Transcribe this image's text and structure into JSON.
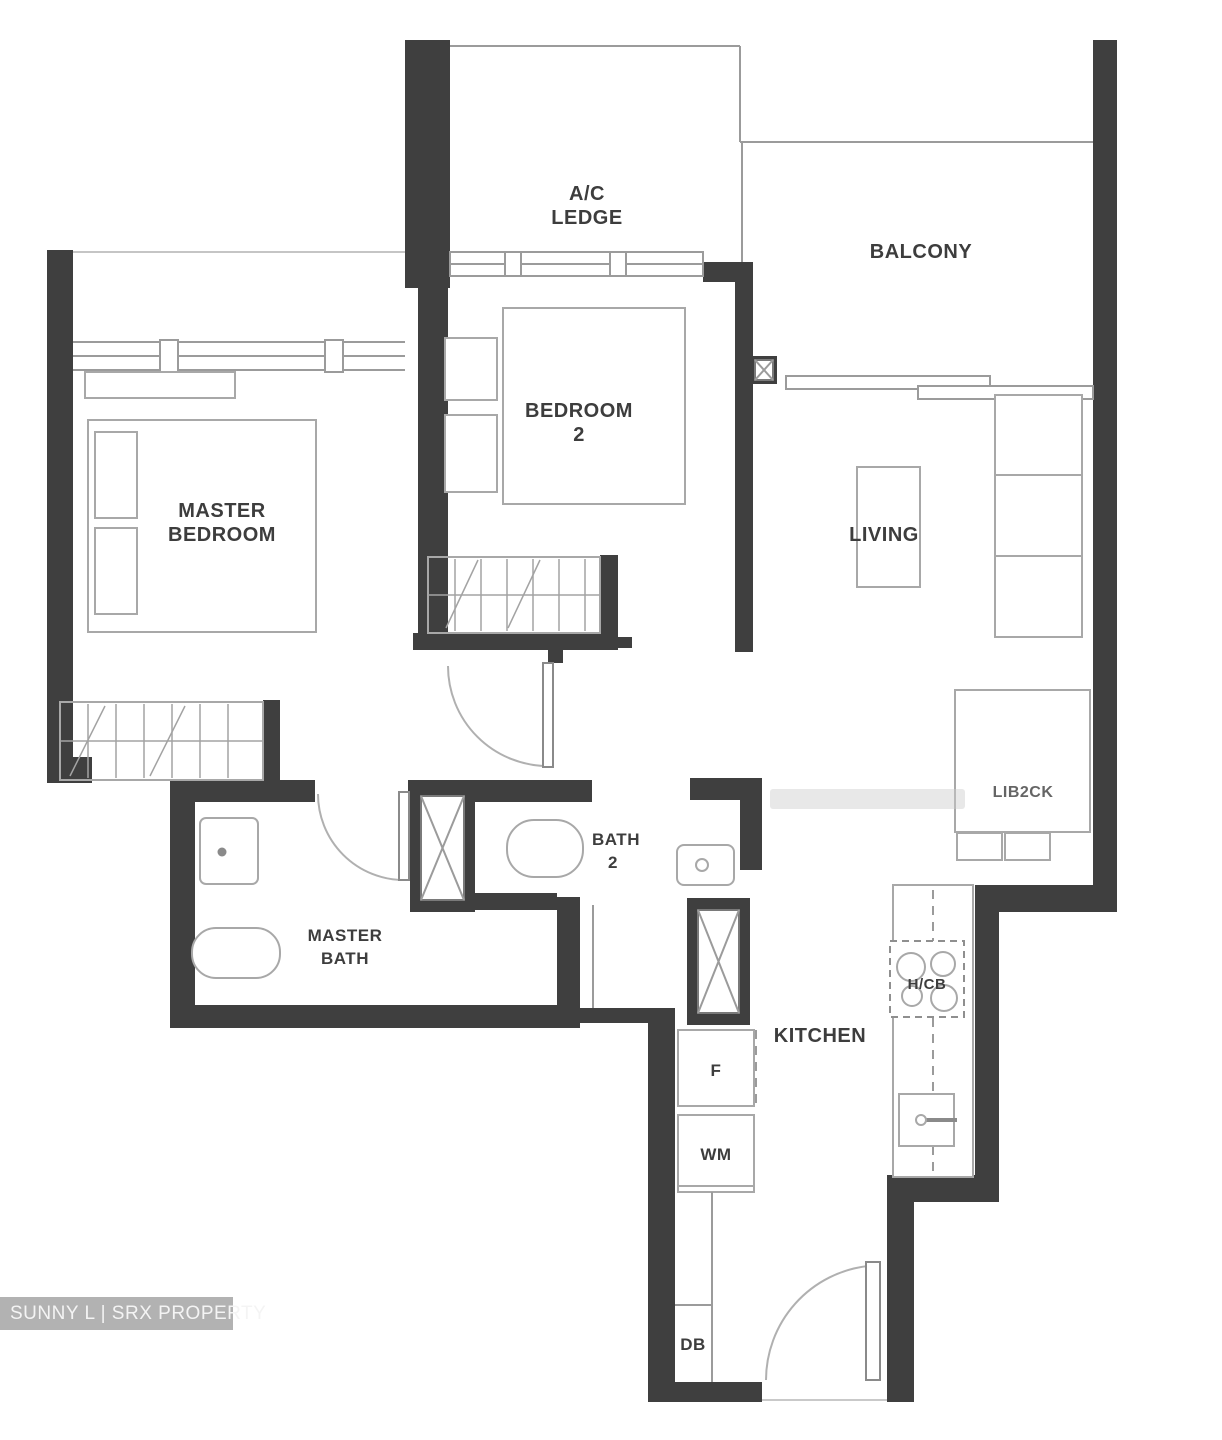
{
  "watermark": {
    "text": "SUNNY L | SRX PROPERTY"
  },
  "rooms": {
    "ac_ledge": {
      "label": [
        "A/C",
        "LEDGE"
      ]
    },
    "balcony": {
      "label": "BALCONY"
    },
    "bedroom2": {
      "label": [
        "BEDROOM",
        "2"
      ]
    },
    "master_bedroom": {
      "label": [
        "MASTER",
        "BEDROOM"
      ]
    },
    "living": {
      "label": "LIVING"
    },
    "master_bath": {
      "label": [
        "MASTER",
        "BATH"
      ]
    },
    "bath2": {
      "label": [
        "BATH",
        "2"
      ]
    },
    "kitchen": {
      "label": "KITCHEN"
    }
  },
  "fixtures": {
    "fridge": "F",
    "washing_machine": "WM",
    "distribution_board": "DB",
    "hob": "H/CB",
    "dining_note": "LIB2CK"
  },
  "colors": {
    "wall": "#3f3f3f",
    "thin_line": "#9b9b9b",
    "furniture_line": "#a8a8a8",
    "label_text": "#3d3d3d",
    "watermark_bg": "#b2b2b2",
    "watermark_text": "#f4f4f4"
  }
}
